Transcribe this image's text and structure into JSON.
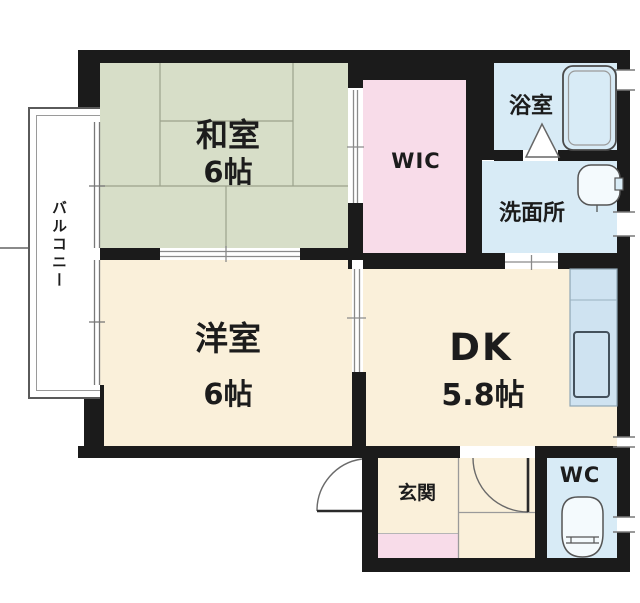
{
  "floorplan": {
    "type": "apartment-floor-plan",
    "rooms": {
      "washitsu": {
        "label": "和室",
        "size": "6帖"
      },
      "youshitsu": {
        "label": "洋室",
        "size": "6帖"
      },
      "dk": {
        "label": "DK",
        "size": "5.8帖"
      },
      "wic": {
        "label": "WIC"
      },
      "bathroom": {
        "label": "浴室"
      },
      "washroom": {
        "label": "洗面所"
      },
      "genkan": {
        "label": "玄関"
      },
      "wc": {
        "label": "WC"
      },
      "balcony": {
        "label": "バルコニー"
      }
    },
    "colors": {
      "wall": "#1b1b1b",
      "tatami_green": "#d7dec8",
      "flooring_cream": "#faf0da",
      "closet_pink": "#f8dce9",
      "wet_area_blue": "#d8ebf6",
      "counter_blue": "#cfe3f1",
      "fixture_white": "#f4fafd",
      "outline_gray": "#555555"
    }
  }
}
